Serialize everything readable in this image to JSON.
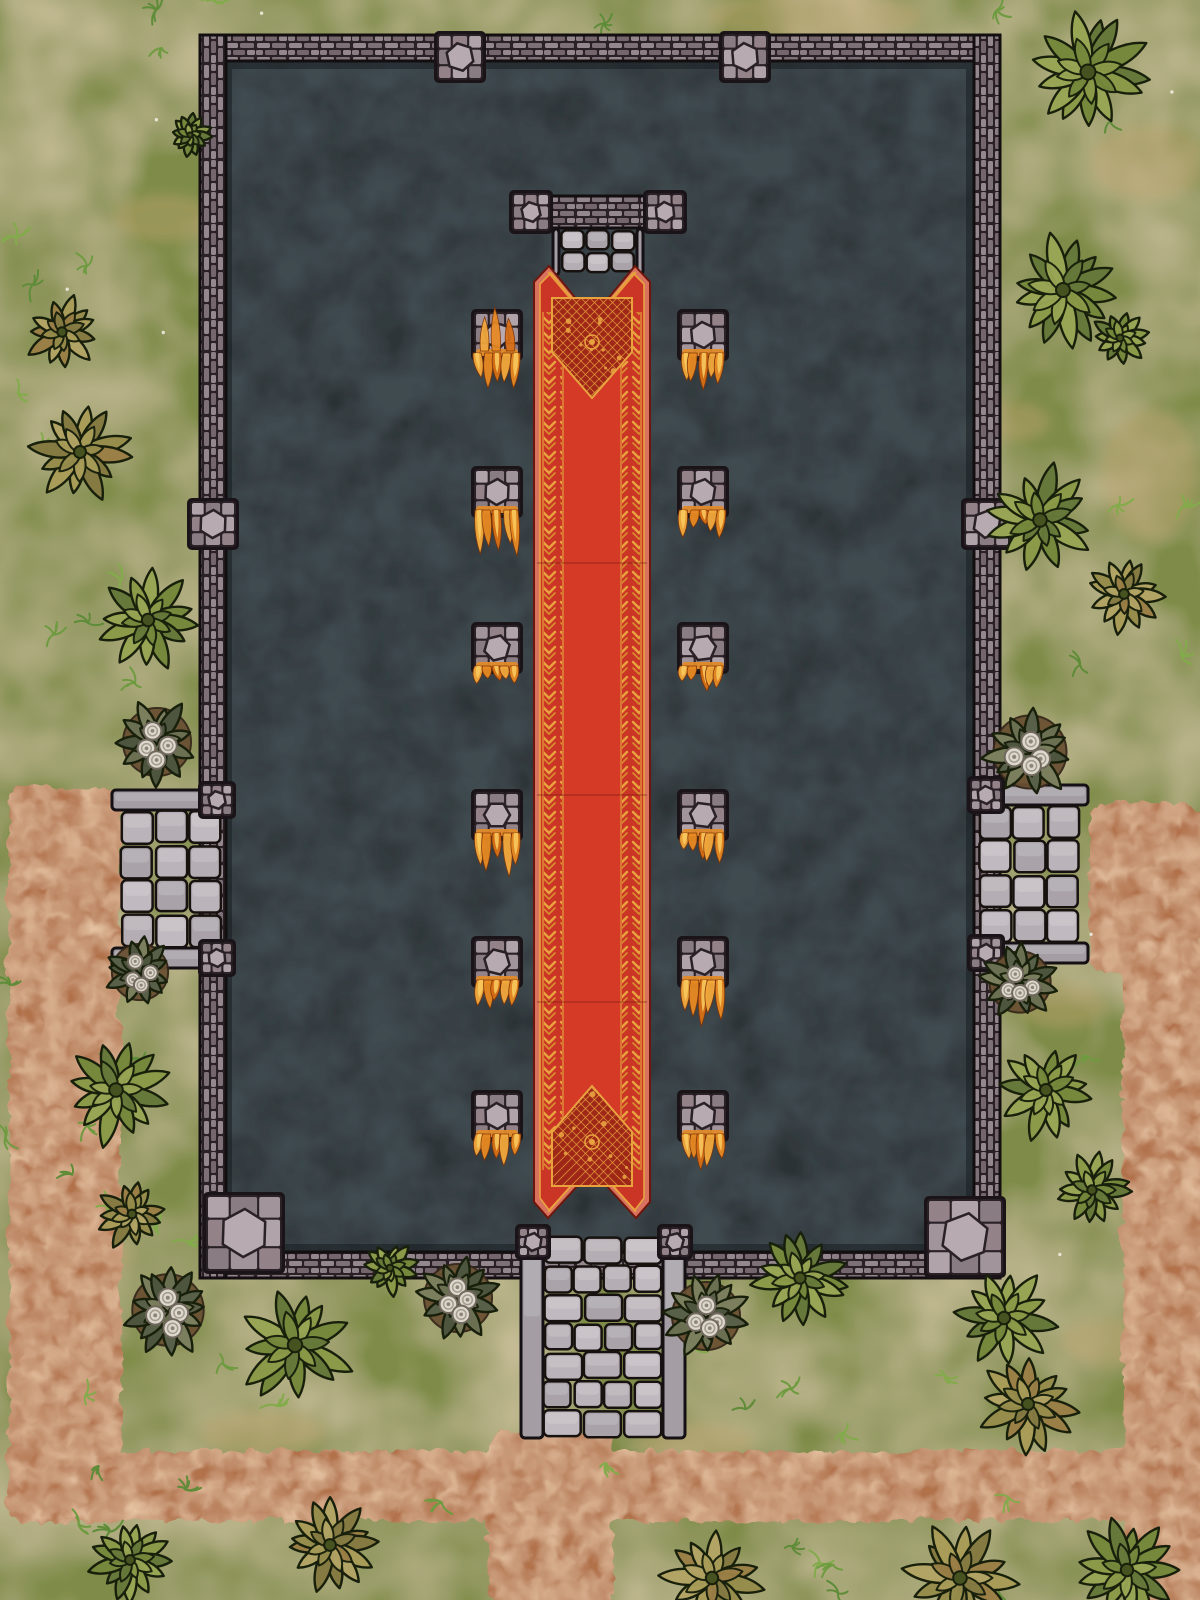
{
  "map": {
    "kind": "fantasy-temple-battle-map",
    "canvas": {
      "w": 1200,
      "h": 1600
    },
    "visible_text": "none"
  },
  "palette": {
    "grass": "#7f8c48",
    "grass_dark": [
      0.22,
      0.29,
      0.12
    ],
    "grass_light": [
      0.64,
      0.65,
      0.35
    ],
    "sand_noise": [
      0.73,
      0.62,
      0.42
    ],
    "sand_patch": "#c2a671",
    "dirt": "#b1714a",
    "dirt_dark": [
      0.42,
      0.23,
      0.11
    ],
    "dirt_light": [
      0.84,
      0.6,
      0.4
    ],
    "floor": "#2b3134",
    "floor_light": [
      0.26,
      0.3,
      0.32
    ],
    "floor_dark": [
      0.05,
      0.07,
      0.08
    ],
    "seam": "#2a2126",
    "outline": "#130e10",
    "wall1": "#95878e",
    "wall2": "#7e7077",
    "wall3": "#8b7d84",
    "wall4": "#75666d",
    "cobble": [
      "#a2949b",
      "#8a7c83",
      "#b0a3a9",
      "#948289"
    ],
    "hex_stone": "#b7abb1",
    "step_fills": [
      "#b4adb3",
      "#c0b9bf",
      "#a9a2a8",
      "#bab3b9"
    ],
    "rail": "#a49ea4",
    "rail_cap": "#b1abb1",
    "carpet_edge": "#d8715e",
    "carpet_red": "#cb3526",
    "carpet_red_bright": "#d63b28",
    "carpet_panel": "#9e2718",
    "gold": "#e8a33f",
    "gold_dim": "#d98f2e",
    "flame": [
      "#f4a93c",
      "#e88a22",
      "#d96f15"
    ],
    "flame_hi": "#f8c95e",
    "flame_base": "#e08a28",
    "tuft_greens": [
      "#6f9b40",
      "#83ab4b",
      "#5f8c38"
    ],
    "leaf_green": [
      "#75883c",
      "#8b9a48",
      "#67793a",
      "#98a554"
    ],
    "leaf_olive": [
      "#968c4c",
      "#a89c58",
      "#857a42",
      "#b2a464",
      "#9a7f46"
    ],
    "leaf_gray": [
      "#6b7052",
      "#596049",
      "#7c7f5e",
      "#4e553f"
    ],
    "rose": "#ddd8cd",
    "rose_line": "#a39b8d",
    "rose_core": "#8d8577",
    "flower_dirt": "#6a5133"
  },
  "ground": {
    "dirt_regions": [
      [
        6,
        785,
        112,
        735
      ],
      [
        60,
        1448,
        1140,
        70
      ],
      [
        484,
        1430,
        126,
        170
      ],
      [
        1120,
        838,
        80,
        762
      ],
      [
        1086,
        800,
        114,
        168
      ]
    ],
    "sand_patches": [
      [
        300,
        135,
        85,
        36
      ],
      [
        165,
        218,
        52,
        24
      ],
      [
        815,
        16,
        110,
        24
      ],
      [
        1148,
        162,
        58,
        38
      ],
      [
        425,
        62,
        48,
        20
      ],
      [
        1012,
        422,
        38,
        20
      ],
      [
        1150,
        475,
        48,
        66
      ],
      [
        1062,
        1006,
        44,
        22
      ],
      [
        262,
        1432,
        64,
        22
      ],
      [
        97,
        1257,
        36,
        18
      ],
      [
        1108,
        1342,
        48,
        24
      ],
      [
        695,
        1442,
        60,
        20
      ]
    ],
    "tufts": {
      "count": 95,
      "seed": 1234
    },
    "specks": {
      "count": 14,
      "seed": 77
    }
  },
  "temple": {
    "wall": {
      "x": 200,
      "y": 35,
      "w": 800,
      "h": 1243,
      "thickness": 26
    },
    "floor": {
      "x": 224,
      "y": 61,
      "w": 750,
      "h": 1191
    },
    "wall_pillars": [
      [
        460,
        57
      ],
      [
        745,
        57
      ],
      [
        213,
        524
      ],
      [
        987,
        524
      ]
    ],
    "pillar_size": 46,
    "corner_blocks": [
      [
        244,
        1233
      ],
      [
        965,
        1237
      ]
    ],
    "corner_size": 76,
    "north_gate": {
      "lintel": [
        523,
        196,
        150,
        32
      ],
      "caps": [
        [
          531,
          212
        ],
        [
          665,
          212
        ]
      ],
      "cap_size": 38,
      "steps": [
        560,
        229,
        76,
        44
      ],
      "step_cols": 3,
      "step_rows": 2,
      "rails": [
        [
          553,
          229,
          6,
          46
        ],
        [
          637,
          229,
          6,
          46
        ]
      ]
    },
    "west_stairs": {
      "rail_top": [
        112,
        790,
        112,
        20
      ],
      "rail_bottom": [
        112,
        948,
        112,
        20
      ],
      "body": [
        120,
        810,
        102,
        138
      ],
      "cols": 3,
      "rows": 4,
      "caps": [
        [
          217,
          800
        ],
        [
          217,
          958
        ]
      ],
      "cap_size": 32
    },
    "east_stairs": {
      "rail_top": [
        976,
        785,
        112,
        20
      ],
      "rail_bottom": [
        976,
        943,
        112,
        20
      ],
      "body": [
        978,
        805,
        102,
        138
      ],
      "cols": 3,
      "rows": 4,
      "caps": [
        [
          986,
          795
        ],
        [
          986,
          953
        ]
      ],
      "cap_size": 32
    },
    "south_stairs": {
      "rails": [
        [
          521,
          1230,
          22,
          208
        ],
        [
          663,
          1230,
          22,
          208
        ]
      ],
      "caps": [
        [
          533,
          1242
        ],
        [
          675,
          1242
        ]
      ],
      "cap_size": 30,
      "steps": [
        543,
        1236,
        120,
        202
      ],
      "rows": 7
    }
  },
  "carpet": {
    "cx": 592,
    "left": 534,
    "right": 650,
    "top": 266,
    "bottom": 1218,
    "horn_x": [
      549,
      635
    ],
    "tail_x": [
      548,
      636
    ],
    "bands": {
      "y1": 312,
      "y2": 1170,
      "left_x": 544,
      "right_x": 622,
      "w": 18
    },
    "panel_top": [
      [
        552,
        298
      ],
      [
        632,
        298
      ],
      [
        632,
        352
      ],
      [
        592,
        398
      ],
      [
        552,
        352
      ]
    ],
    "panel_bottom": [
      [
        552,
        1186
      ],
      [
        632,
        1186
      ],
      [
        632,
        1132
      ],
      [
        592,
        1086
      ],
      [
        552,
        1132
      ]
    ],
    "medallions": [
      [
        592,
        342
      ],
      [
        592,
        1142
      ]
    ],
    "creases_y": [
      563,
      795,
      1002
    ]
  },
  "pedestals": {
    "size": 46,
    "items": [
      [
        497,
        335,
        42,
        1
      ],
      [
        703,
        335,
        36,
        0
      ],
      [
        497,
        492,
        46,
        0
      ],
      [
        703,
        492,
        26,
        0
      ],
      [
        497,
        648,
        20,
        0
      ],
      [
        703,
        648,
        24,
        0
      ],
      [
        497,
        815,
        42,
        0
      ],
      [
        703,
        815,
        30,
        0
      ],
      [
        497,
        962,
        26,
        0
      ],
      [
        703,
        962,
        44,
        0
      ],
      [
        497,
        1116,
        30,
        0
      ],
      [
        703,
        1116,
        34,
        0
      ]
    ]
  },
  "plants": [
    [
      1088,
      72,
      58,
      "green"
    ],
    [
      190,
      135,
      20,
      "green"
    ],
    [
      62,
      332,
      36,
      "olive"
    ],
    [
      1063,
      290,
      54,
      "green"
    ],
    [
      1120,
      338,
      27,
      "green"
    ],
    [
      80,
      452,
      46,
      "olive"
    ],
    [
      1040,
      520,
      52,
      "green"
    ],
    [
      1124,
      594,
      38,
      "olive"
    ],
    [
      148,
      620,
      48,
      "green"
    ],
    [
      157,
      742,
      40,
      "flower"
    ],
    [
      1030,
      752,
      43,
      "flower"
    ],
    [
      140,
      972,
      33,
      "flower"
    ],
    [
      1020,
      982,
      36,
      "flower"
    ],
    [
      116,
      1090,
      52,
      "green"
    ],
    [
      1046,
      1090,
      46,
      "green"
    ],
    [
      132,
      1214,
      34,
      "olive"
    ],
    [
      1092,
      1190,
      36,
      "green"
    ],
    [
      168,
      1310,
      42,
      "flower"
    ],
    [
      295,
      1345,
      55,
      "green"
    ],
    [
      390,
      1268,
      26,
      "green"
    ],
    [
      458,
      1298,
      40,
      "flower"
    ],
    [
      706,
      1316,
      40,
      "flower"
    ],
    [
      800,
      1278,
      44,
      "green"
    ],
    [
      1004,
      1318,
      48,
      "green"
    ],
    [
      1028,
      1404,
      46,
      "olive"
    ],
    [
      330,
      1545,
      45,
      "olive"
    ],
    [
      130,
      1560,
      38,
      "green"
    ],
    [
      712,
      1578,
      48,
      "olive"
    ],
    [
      960,
      1578,
      52,
      "olive"
    ],
    [
      1127,
      1570,
      48,
      "green"
    ]
  ]
}
